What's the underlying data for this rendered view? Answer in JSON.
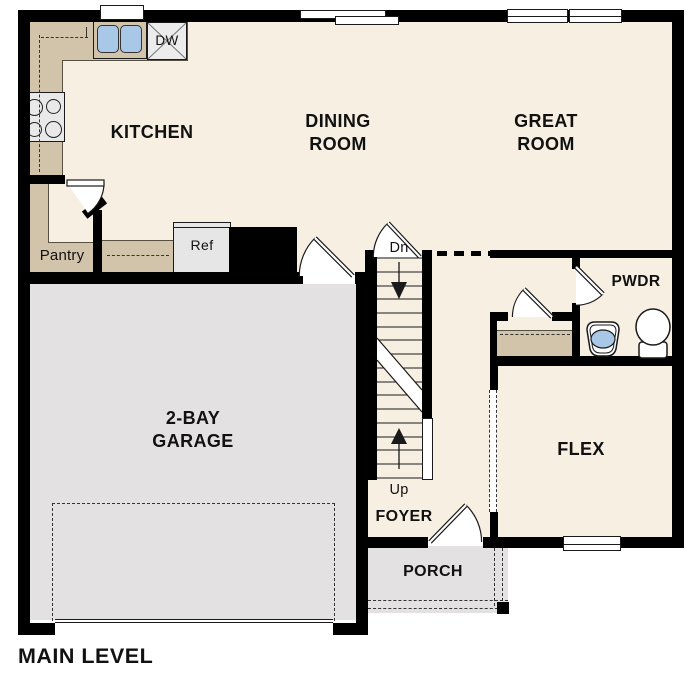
{
  "meta": {
    "plan_title": "MAIN LEVEL"
  },
  "rooms": {
    "kitchen": "KITCHEN",
    "dining_room": "DINING ROOM",
    "great_room": "GREAT ROOM",
    "garage": "2-BAY GARAGE",
    "flex": "FLEX",
    "powder_room": "PWDR",
    "foyer": "FOYER",
    "porch": "PORCH",
    "pantry": "Pantry"
  },
  "appliances": {
    "refrigerator": "Ref",
    "dishwasher": "DW"
  },
  "stairs": {
    "down_label": "Dn",
    "up_label": "Up"
  },
  "colors": {
    "floor_cream": "#f6efe2",
    "counter_tan": "#d2c4ab",
    "garage_gray": "#e3e1e1",
    "wall_black": "#000000",
    "sink_blue": "#a9c8e8",
    "appliance_gray": "#e9e9e9",
    "label_text": "#111111"
  }
}
